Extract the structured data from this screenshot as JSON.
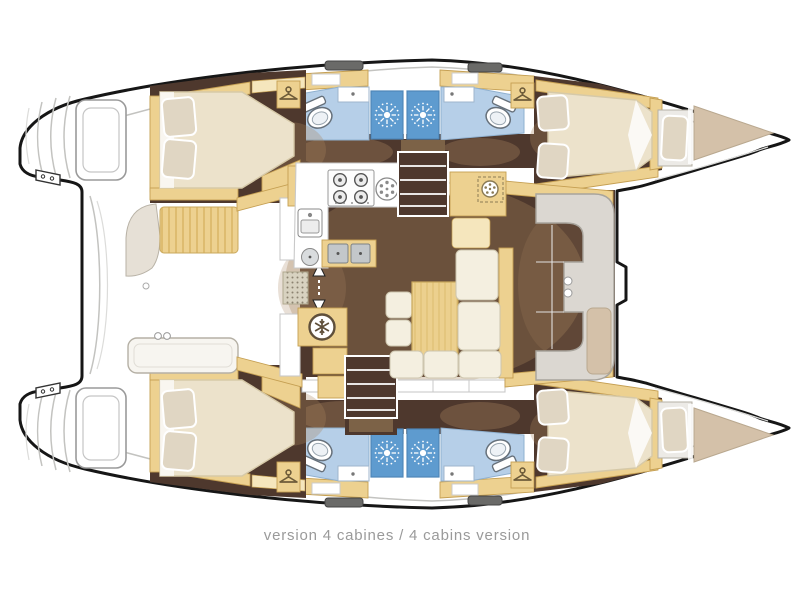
{
  "caption": {
    "text": "version 4 cabines / 4 cabins version"
  },
  "colors": {
    "outline": "#161616",
    "grey_line": "#c3c3c0",
    "floor_dark": "#4e382d",
    "glow": "#a8855e",
    "wood": "#edd190",
    "wood_dark": "#c59f52",
    "wood_light": "#f5e6bd",
    "bed": "#ece2cb",
    "bed_stroke": "#d6c9a8",
    "pillow": "#e0d6c3",
    "sofa": "#f4efe0",
    "sofa_stroke": "#cdc5ae",
    "bath": "#b6cfe8",
    "shower": "#5e9bcf",
    "seat_grey": "#dbd7d1",
    "beige": "#d4c1a9",
    "steel": "#c3c7ca",
    "caption_grey": "#9a9a9a"
  },
  "icons": {
    "shower": "sunburst-shower-rose",
    "wardrobe": "clothes-hanger",
    "fridge": "snowflake",
    "stove": "four-burner-hob",
    "companionway": "steps",
    "entry_door": "up-down-arrows",
    "nav_instrument": "dial"
  }
}
